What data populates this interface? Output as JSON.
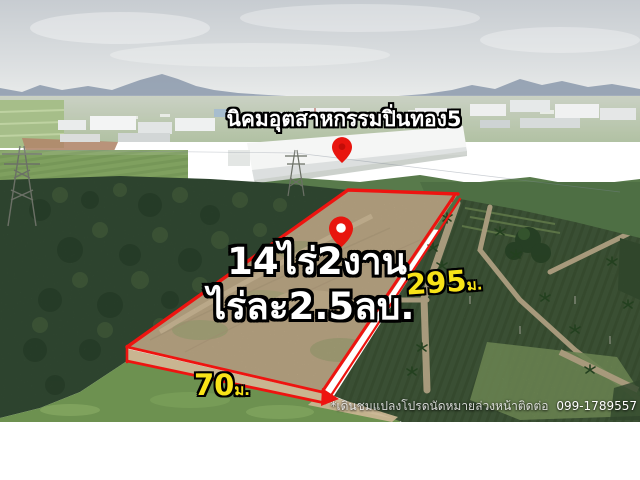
{
  "listing": {
    "estate_label": "นิคมอุตสาหกรรมปิ่นทอง5",
    "area_text": "14ไร่2งาน",
    "price_text": "ไร่ละ2.5ลบ.",
    "dimensions": {
      "length": {
        "value": "295",
        "unit": "ม."
      },
      "width": {
        "value": "70",
        "unit": "ม."
      }
    },
    "footer": {
      "note": "*เดินชมแปลงโปรดนัดหมายล่วงหน้าติดต่อ",
      "phone": "099-1789557"
    },
    "colors": {
      "boundary_red": "#ee1410",
      "dimension_yellow": "#f8e318",
      "pin_red": "#e8150e"
    },
    "icons": {
      "estate_pin": "location-pin",
      "plot_pin": "location-pin"
    }
  }
}
